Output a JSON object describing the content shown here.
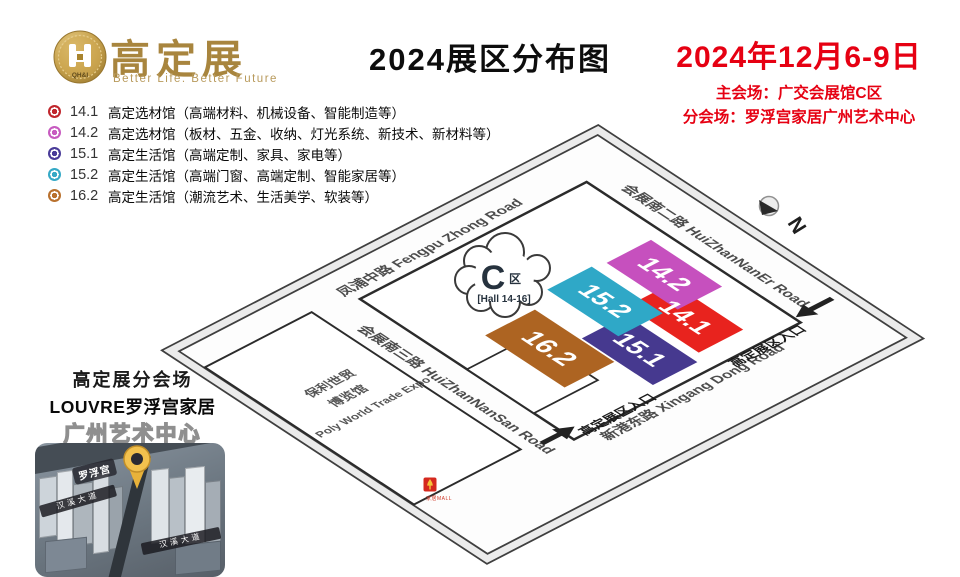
{
  "header": {
    "logo": {
      "brand": "高定展",
      "tagline": "Better Life. Better Future",
      "coin_text": "QH&I"
    },
    "title": "2024展区分布图",
    "date": "2024年12月6-9日",
    "venue_main": "主会场：广交会展馆C区",
    "venue_branch": "分会场：罗浮宫家居广州艺术中心",
    "accent_color": "#e60012",
    "brand_gold": "#a8853e"
  },
  "legend": {
    "items": [
      {
        "num": "14.1",
        "color": "#c1272d",
        "label": "高定选材馆（高端材料、机械设备、智能制造等）"
      },
      {
        "num": "14.2",
        "color": "#c75bc0",
        "label": "高定选材馆（板材、五金、收纳、灯光系统、新技术、新材料等）"
      },
      {
        "num": "15.1",
        "color": "#4a3c99",
        "label": "高定生活馆（高端定制、家具、家电等）"
      },
      {
        "num": "15.2",
        "color": "#35a9c6",
        "label": "高定生活馆（高端门窗、高端定制、智能家居等）"
      },
      {
        "num": "16.2",
        "color": "#b9712e",
        "label": "高定生活馆（潮流艺术、生活美学、软装等）"
      }
    ]
  },
  "map": {
    "zone_cloud": {
      "big": "C",
      "small": "区",
      "hall_range": "[Hall 14-16]"
    },
    "north_label": "N",
    "roads": {
      "fengpu": "凤浦中路  Fengpu Zhong Road",
      "huizhan_naner": "会展南二路  HuiZhanNanEr Road",
      "huizhan_nansan": "会展南三路  HuiZhanNanSan Road",
      "xingang": "新港东路  Xingang Dong Road"
    },
    "halls": [
      {
        "id": "15.1",
        "color": "#46398f"
      },
      {
        "id": "14.1",
        "color": "#e8231e"
      },
      {
        "id": "15.2",
        "color": "#2fa8c7"
      },
      {
        "id": "14.2",
        "color": "#c650be"
      },
      {
        "id": "16.2",
        "color": "#ad6422"
      }
    ],
    "poly_building": {
      "line1": "保利世贸",
      "line2": "博览馆",
      "line3": "Poly World Trade Expo"
    },
    "entrance_label": "高定展区入口",
    "mini_logo_caption": "家居MALL"
  },
  "branch": {
    "heading": "高定展分会场",
    "brand": "LOUVRE罗浮宫家居",
    "venue": "广州艺术中心",
    "pin_label": "罗浮宫",
    "road_ribbons": [
      "汉溪大道",
      "汉溪大道"
    ]
  }
}
